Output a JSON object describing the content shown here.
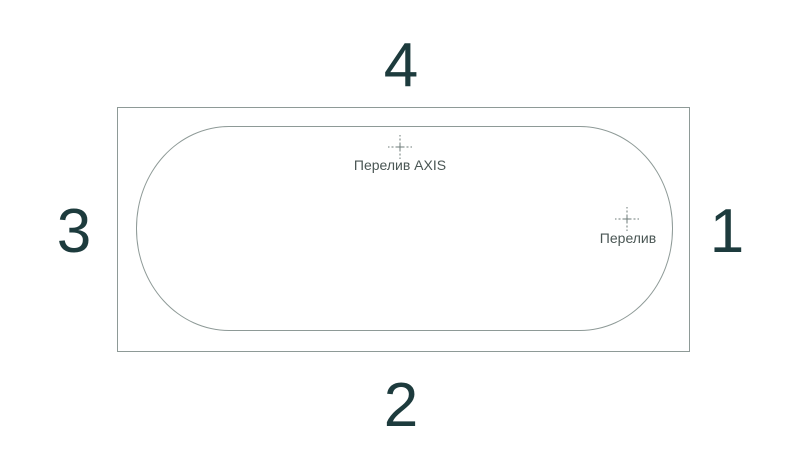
{
  "diagram": {
    "type": "bathtub-top-view-scheme",
    "sides": {
      "top": "4",
      "bottom": "2",
      "left": "3",
      "right": "1"
    },
    "markers": {
      "overflow_axis": {
        "label": "Перелив AXIS",
        "position": "top-center"
      },
      "overflow": {
        "label": "Перелив",
        "position": "right"
      }
    },
    "colors": {
      "line": "#8e9a97",
      "number": "#1d3b3d",
      "label": "#4a5654",
      "crosshair": "#6e7b78",
      "background": "#ffffff"
    }
  }
}
